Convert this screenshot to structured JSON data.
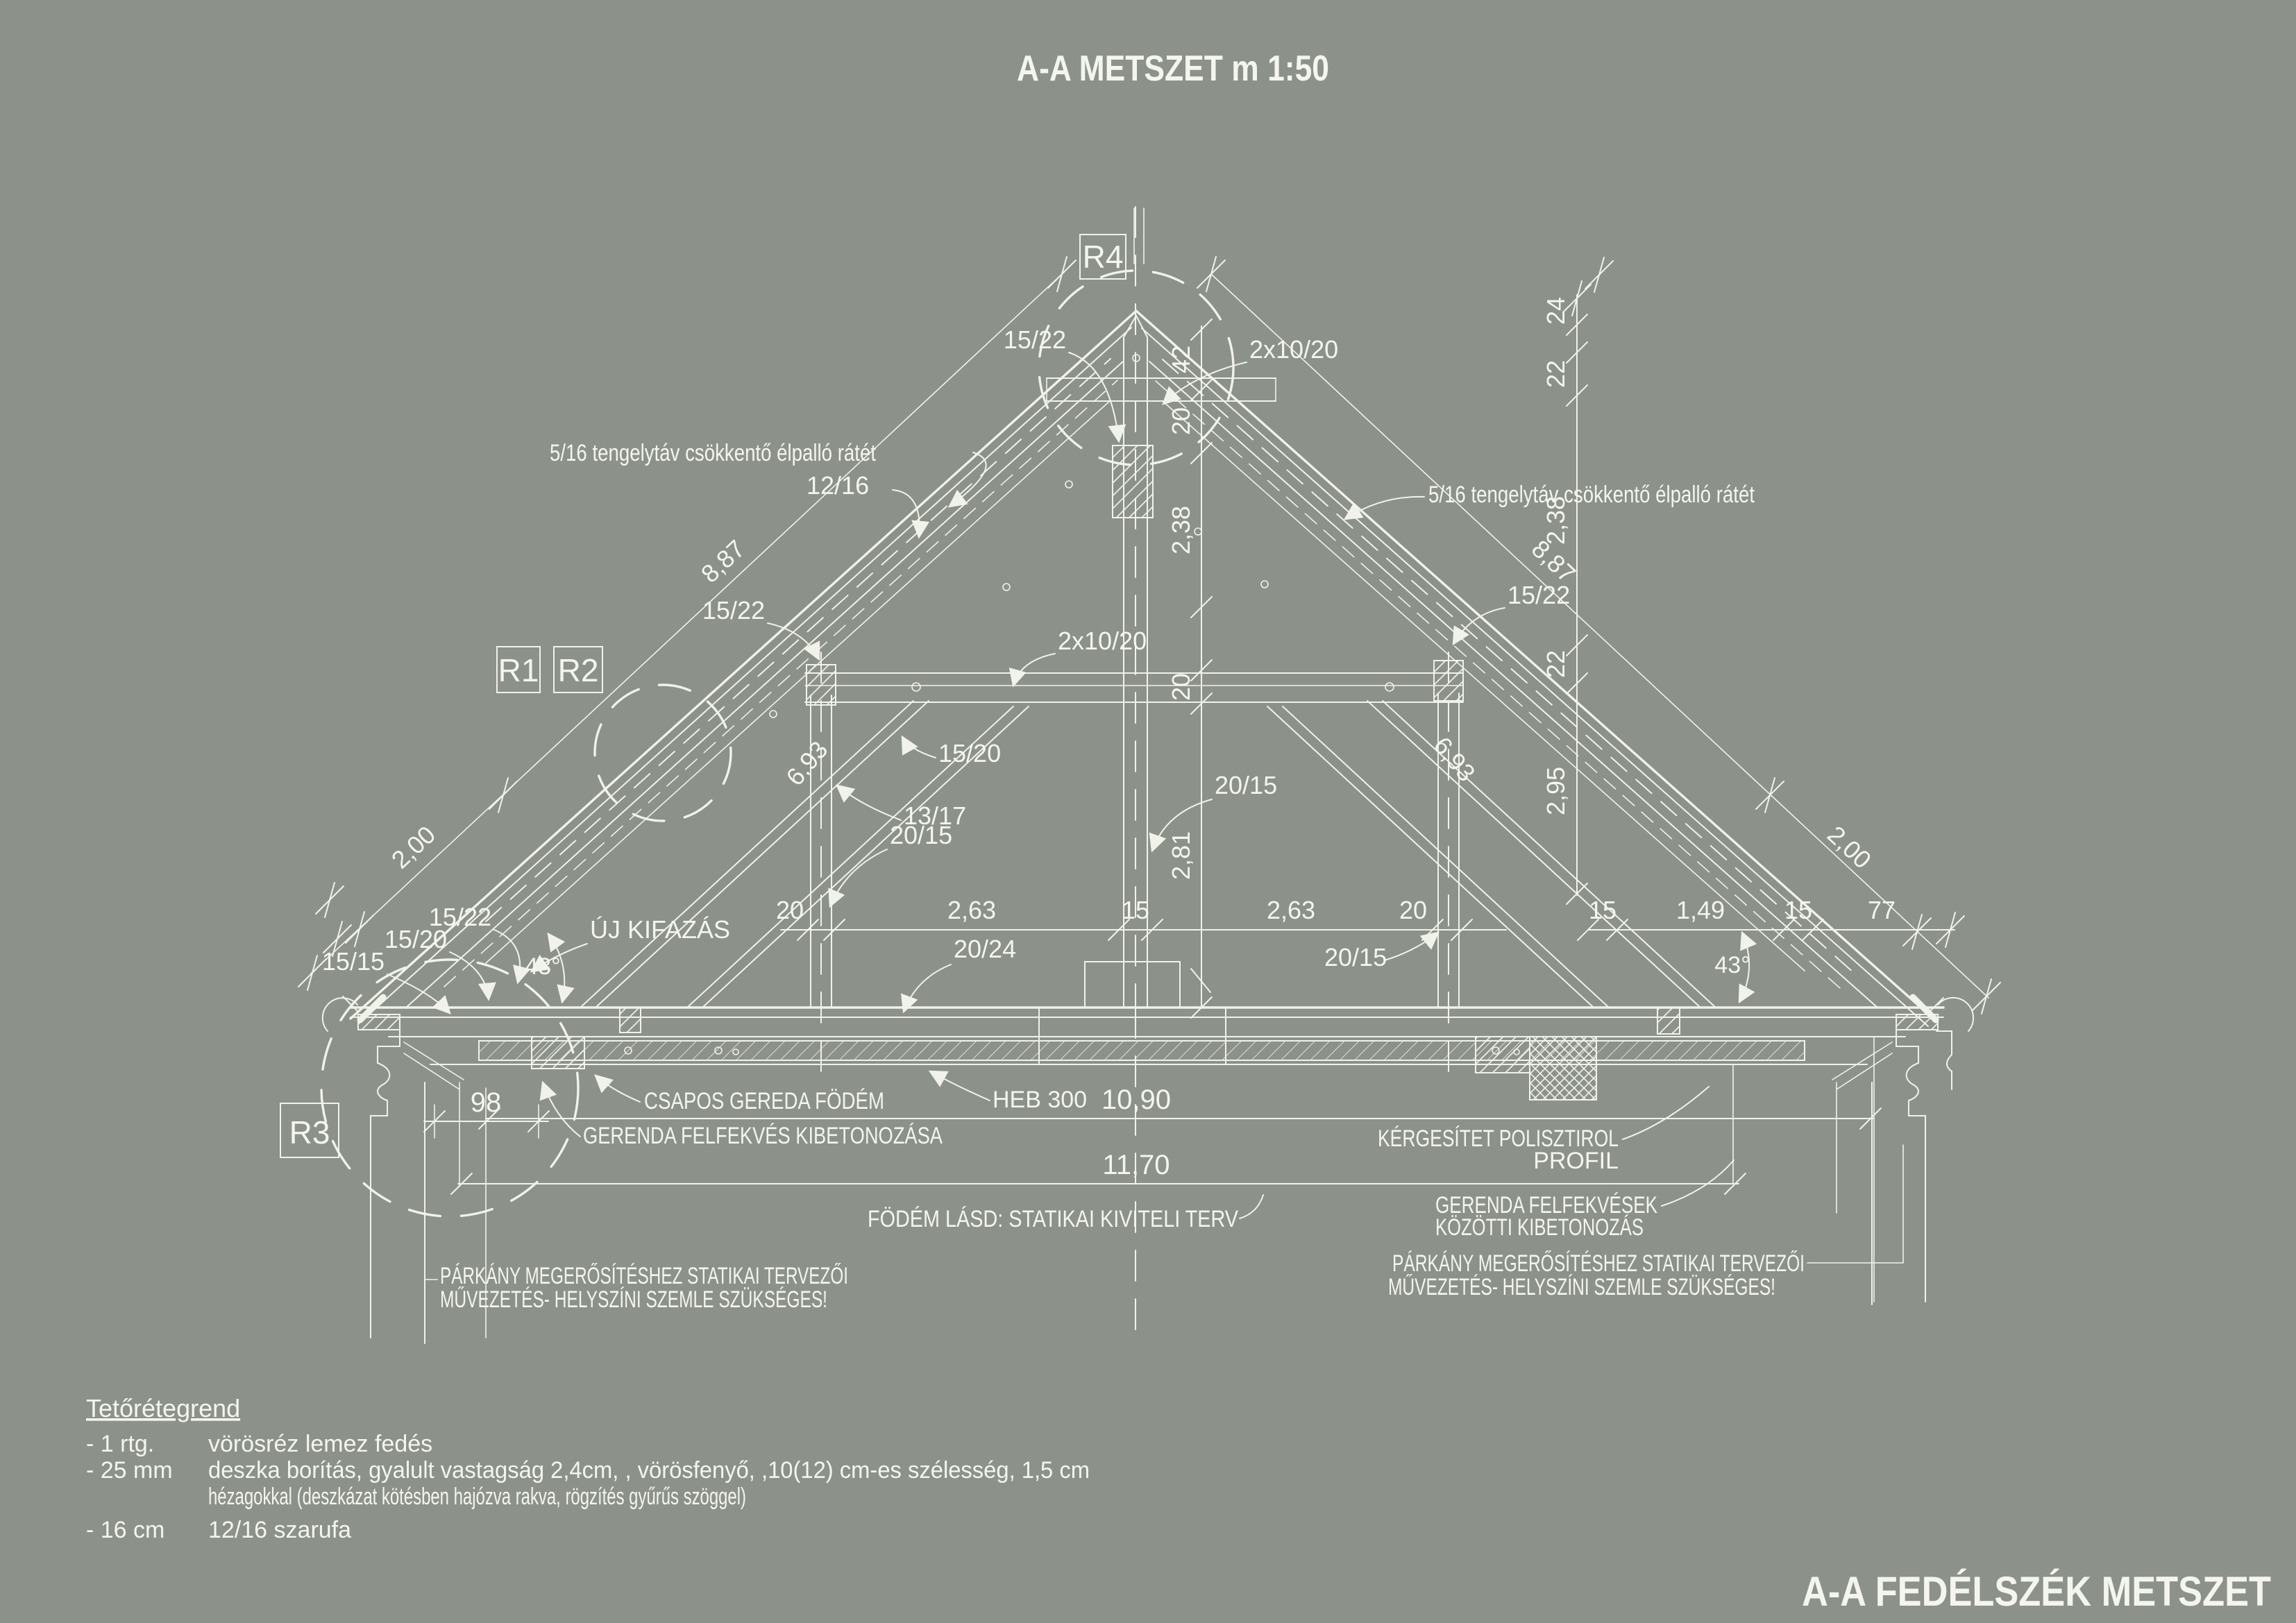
{
  "meta": {
    "title": "A-A METSZET m 1:50",
    "footer": "A-A FEDÉLSZÉK METSZET"
  },
  "colors": {
    "background": "#8c928a",
    "line": "#f1f2ea",
    "text": "#f4f5ee"
  },
  "markers": {
    "r1": "R1",
    "r2": "R2",
    "r3": "R3",
    "r4": "R4"
  },
  "ann": {
    "ratet_left": "5/16 tengelytáv csökkentő élpalló rátét",
    "ratet_right": "5/16 tengelytáv csökkentő élpalló rátét",
    "rafter_12_16": "12/16",
    "ridge_15_22": "15/22",
    "ridge_2x10_20": "2x10/20",
    "collar_2x10_20": "2x10/20",
    "post_left_15_22": "15/22",
    "post_right_15_22": "15/22",
    "strut_15_20": "15/20",
    "brace_13_17": "13/17",
    "king_20_15": "20/15",
    "leftpost_20_15": "20/15",
    "rightpost_20_15": "20/15",
    "tie_20_24": "20/24",
    "eaves_15_22": "15/22",
    "eaves_15_20": "15/20",
    "eaves_15_15": "15/15",
    "uj_kifazas": "ÚJ KIFAZÁS",
    "angle_left": "43°",
    "angle_right": "43°",
    "csapos": "CSAPOS GEREDA FÖDÉM",
    "heb": "HEB 300",
    "gerenda_felfekves": "GERENDA FELFEKVÉS KIBETONOZÁSA",
    "kergesitet_1": "KÉRGESÍTET POLISZTIROL",
    "kergesitet_2": "PROFIL",
    "felfekvesek_1": "GERENDA FELFEKVÉSEK",
    "felfekvesek_2": "KÖZÖTTI KIBETONOZÁS",
    "fodem_lasd": "FÖDÉM LÁSD: STATIKAI KIVITELI TERV",
    "parkany_left_1": "PÁRKÁNY MEGERŐSÍTÉSHEZ STATIKAI TERVEZŐI",
    "parkany_left_2": "MŰVEZETÉS- HELYSZÍNI SZEMLE SZÜKSÉGES!",
    "parkany_right_1": "PÁRKÁNY MEGERŐSÍTÉSHEZ STATIKAI TERVEZŐI",
    "parkany_right_2": "MŰVEZETÉS- HELYSZÍNI SZEMLE SZÜKSÉGES!"
  },
  "dims": {
    "row_mid": [
      "20",
      "2,63",
      "15",
      "2,63",
      "20"
    ],
    "row_right": [
      "15",
      "1,49",
      "15",
      "77"
    ],
    "v_center": [
      "42",
      "20",
      "2,38",
      "20",
      "2,81"
    ],
    "v_right": [
      "24",
      "22",
      "2,38",
      "22",
      "2,95"
    ],
    "diag_left": "8,87",
    "diag_right": "8,87",
    "eaves_left": "2,00",
    "eaves_right": "2,00",
    "post_left": "6,93",
    "post_right": "6,93",
    "wall": "98",
    "level_a": "10,90",
    "level_b": "11,70"
  },
  "legend": {
    "heading": "Tetőrétegrend",
    "rows": [
      {
        "qty": "- 1 rtg.",
        "desc": "vörösréz lemez fedés"
      },
      {
        "qty": "- 25 mm",
        "desc": "deszka borítás, gyalult vastagság 2,4cm, , vörösfenyő,  ,10(12) cm-es szélesség, 1,5 cm"
      },
      {
        "qty": "",
        "desc": "hézagokkal (deszkázat kötésben hajózva rakva, rögzítés gyűrűs szöggel)"
      },
      {
        "qty": "- 16 cm",
        "desc": "12/16 szarufa"
      }
    ]
  }
}
